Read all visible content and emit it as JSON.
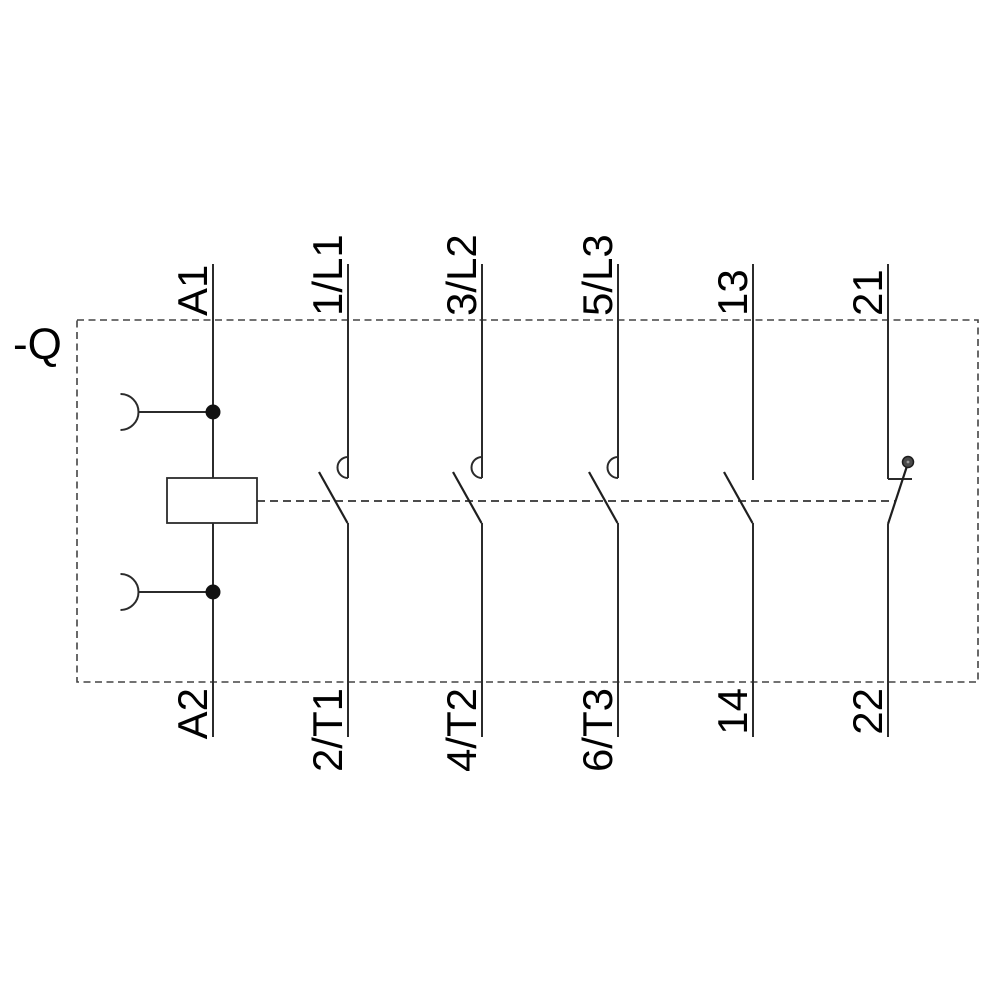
{
  "page": {
    "background": "#ffffff"
  },
  "diagram": {
    "device_label": "-Q",
    "symbol_names": [
      "coil",
      "plug-in-connector",
      "no-main-contact",
      "no-aux-contact",
      "nc-aux-contact"
    ],
    "colors": {
      "line": "#2b2b2b",
      "text": "#000000",
      "dashed_border": "#444444",
      "dashed_link": "#333333",
      "junction_dot": "#111111",
      "pivot_dot": "#4a4a4a"
    },
    "poles": [
      {
        "top": "A1",
        "bottom": "A2",
        "type": "coil"
      },
      {
        "top": "1/L1",
        "bottom": "2/T1",
        "type": "no-main-contact"
      },
      {
        "top": "3/L2",
        "bottom": "4/T2",
        "type": "no-main-contact"
      },
      {
        "top": "5/L3",
        "bottom": "6/T3",
        "type": "no-main-contact"
      },
      {
        "top": "13",
        "bottom": "14",
        "type": "no-aux-contact"
      },
      {
        "top": "21",
        "bottom": "22",
        "type": "nc-aux-contact"
      }
    ]
  }
}
